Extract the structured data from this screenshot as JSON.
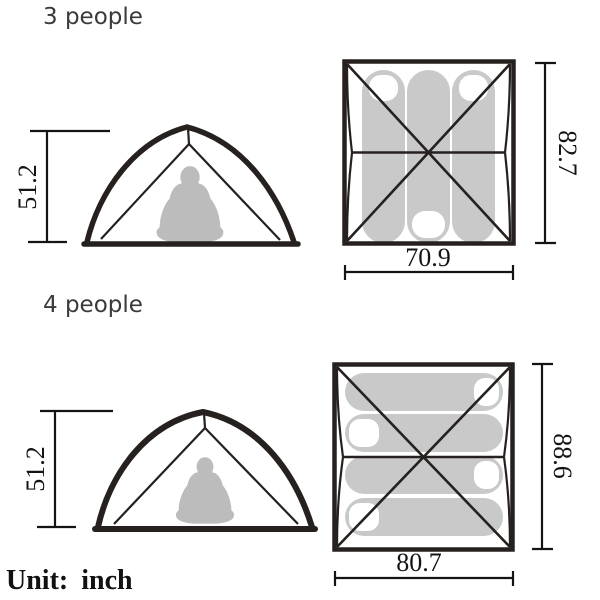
{
  "unit": {
    "label": "Unit:",
    "value": "inch"
  },
  "sections": [
    {
      "id": "3-person",
      "label": "3 people",
      "side_view": {
        "height_in": "51.2"
      },
      "top_view": {
        "width_in": "70.9",
        "depth_in": "82.7",
        "sleeping_bag_count": 3,
        "sleeping_bag_orientation": "vertical"
      }
    },
    {
      "id": "4-person",
      "label": "4 people",
      "side_view": {
        "height_in": "51.2"
      },
      "top_view": {
        "width_in": "80.7",
        "depth_in": "88.6",
        "sleeping_bag_count": 4,
        "sleeping_bag_orientation": "horizontal"
      }
    }
  ],
  "colors": {
    "line": "#26211f",
    "dimension_line": "#141414",
    "sleeping_bag_fill": "#c9c9c9",
    "person_fill": "#bcbcbc",
    "section_label_text": "#3a3a3a",
    "background": "#ffffff"
  }
}
